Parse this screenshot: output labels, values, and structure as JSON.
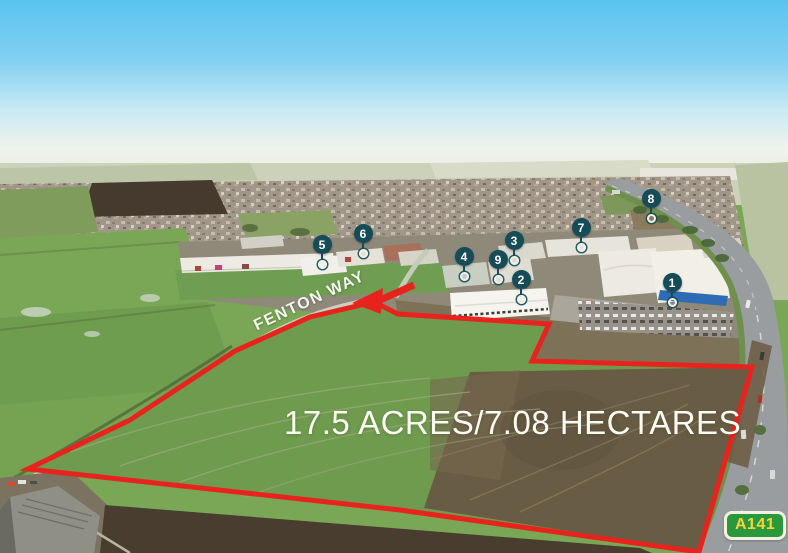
{
  "site": {
    "area_label": "17.5 ACRES/7.08 HECTARES",
    "road_label": "FENTON WAY",
    "route_badge_label": "A141"
  },
  "colors": {
    "boundary_red": "#e8231d",
    "marker_teal": "#164c57",
    "badge_green": "#29993b",
    "badge_text_yellow": "#fbd43c",
    "badge_border": "#f4f1e0"
  },
  "markers": [
    {
      "label": "1",
      "x": 672,
      "y": 283
    },
    {
      "label": "2",
      "x": 521,
      "y": 280
    },
    {
      "label": "3",
      "x": 514,
      "y": 241
    },
    {
      "label": "4",
      "x": 464,
      "y": 257
    },
    {
      "label": "5",
      "x": 322,
      "y": 245
    },
    {
      "label": "6",
      "x": 363,
      "y": 234
    },
    {
      "label": "7",
      "x": 581,
      "y": 228
    },
    {
      "label": "8",
      "x": 651,
      "y": 199
    },
    {
      "label": "9",
      "x": 498,
      "y": 260
    }
  ]
}
